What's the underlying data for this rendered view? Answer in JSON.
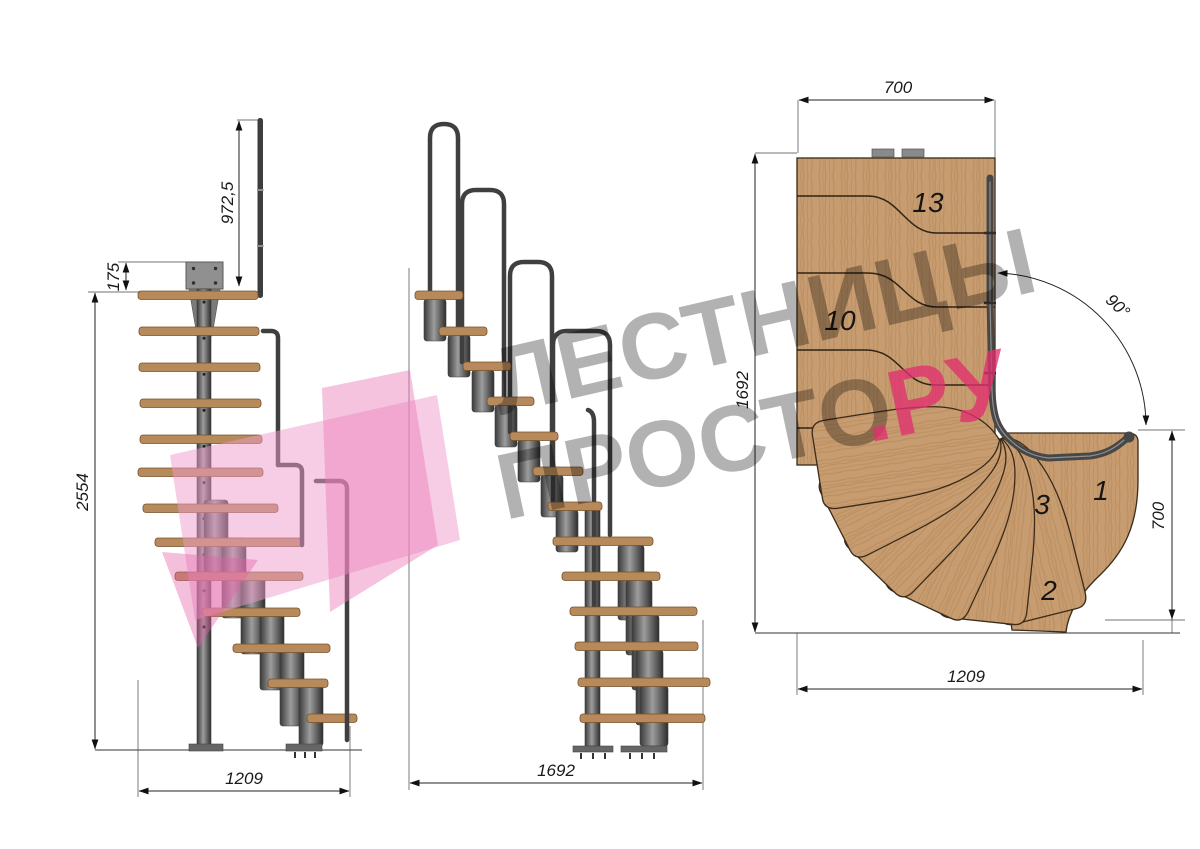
{
  "title": "staircase-technical-drawing",
  "side_view": {
    "dim_total_height": "2554",
    "dim_rail_height": "972,5",
    "dim_plate_offset": "175",
    "dim_run": "1209"
  },
  "front_view": {
    "dim_run": "1692"
  },
  "plan_view": {
    "dim_top_width": "700",
    "dim_depth": "1692",
    "dim_angle": "90°",
    "dim_right_width": "700",
    "dim_bottom_run": "1209",
    "step_13": "13",
    "step_10": "10",
    "step_3": "3",
    "step_2": "2",
    "step_1": "1"
  },
  "watermark": {
    "line1": "ЛЕСТНИЦЫ",
    "line2_gray": "ПРОСТО",
    "line2_pink": ".РУ"
  },
  "colors": {
    "wood_plan": "#c79c70",
    "wood_tread": "#b78a5b",
    "steel_dark": "#3f3f3f",
    "dimension": "#1a1a1a",
    "watermark_pink": "#e0306e",
    "logo_pink_light": "#f09ccb",
    "logo_pink_mid": "#ec79b8",
    "logo_pink_dark": "#e05ea6"
  }
}
